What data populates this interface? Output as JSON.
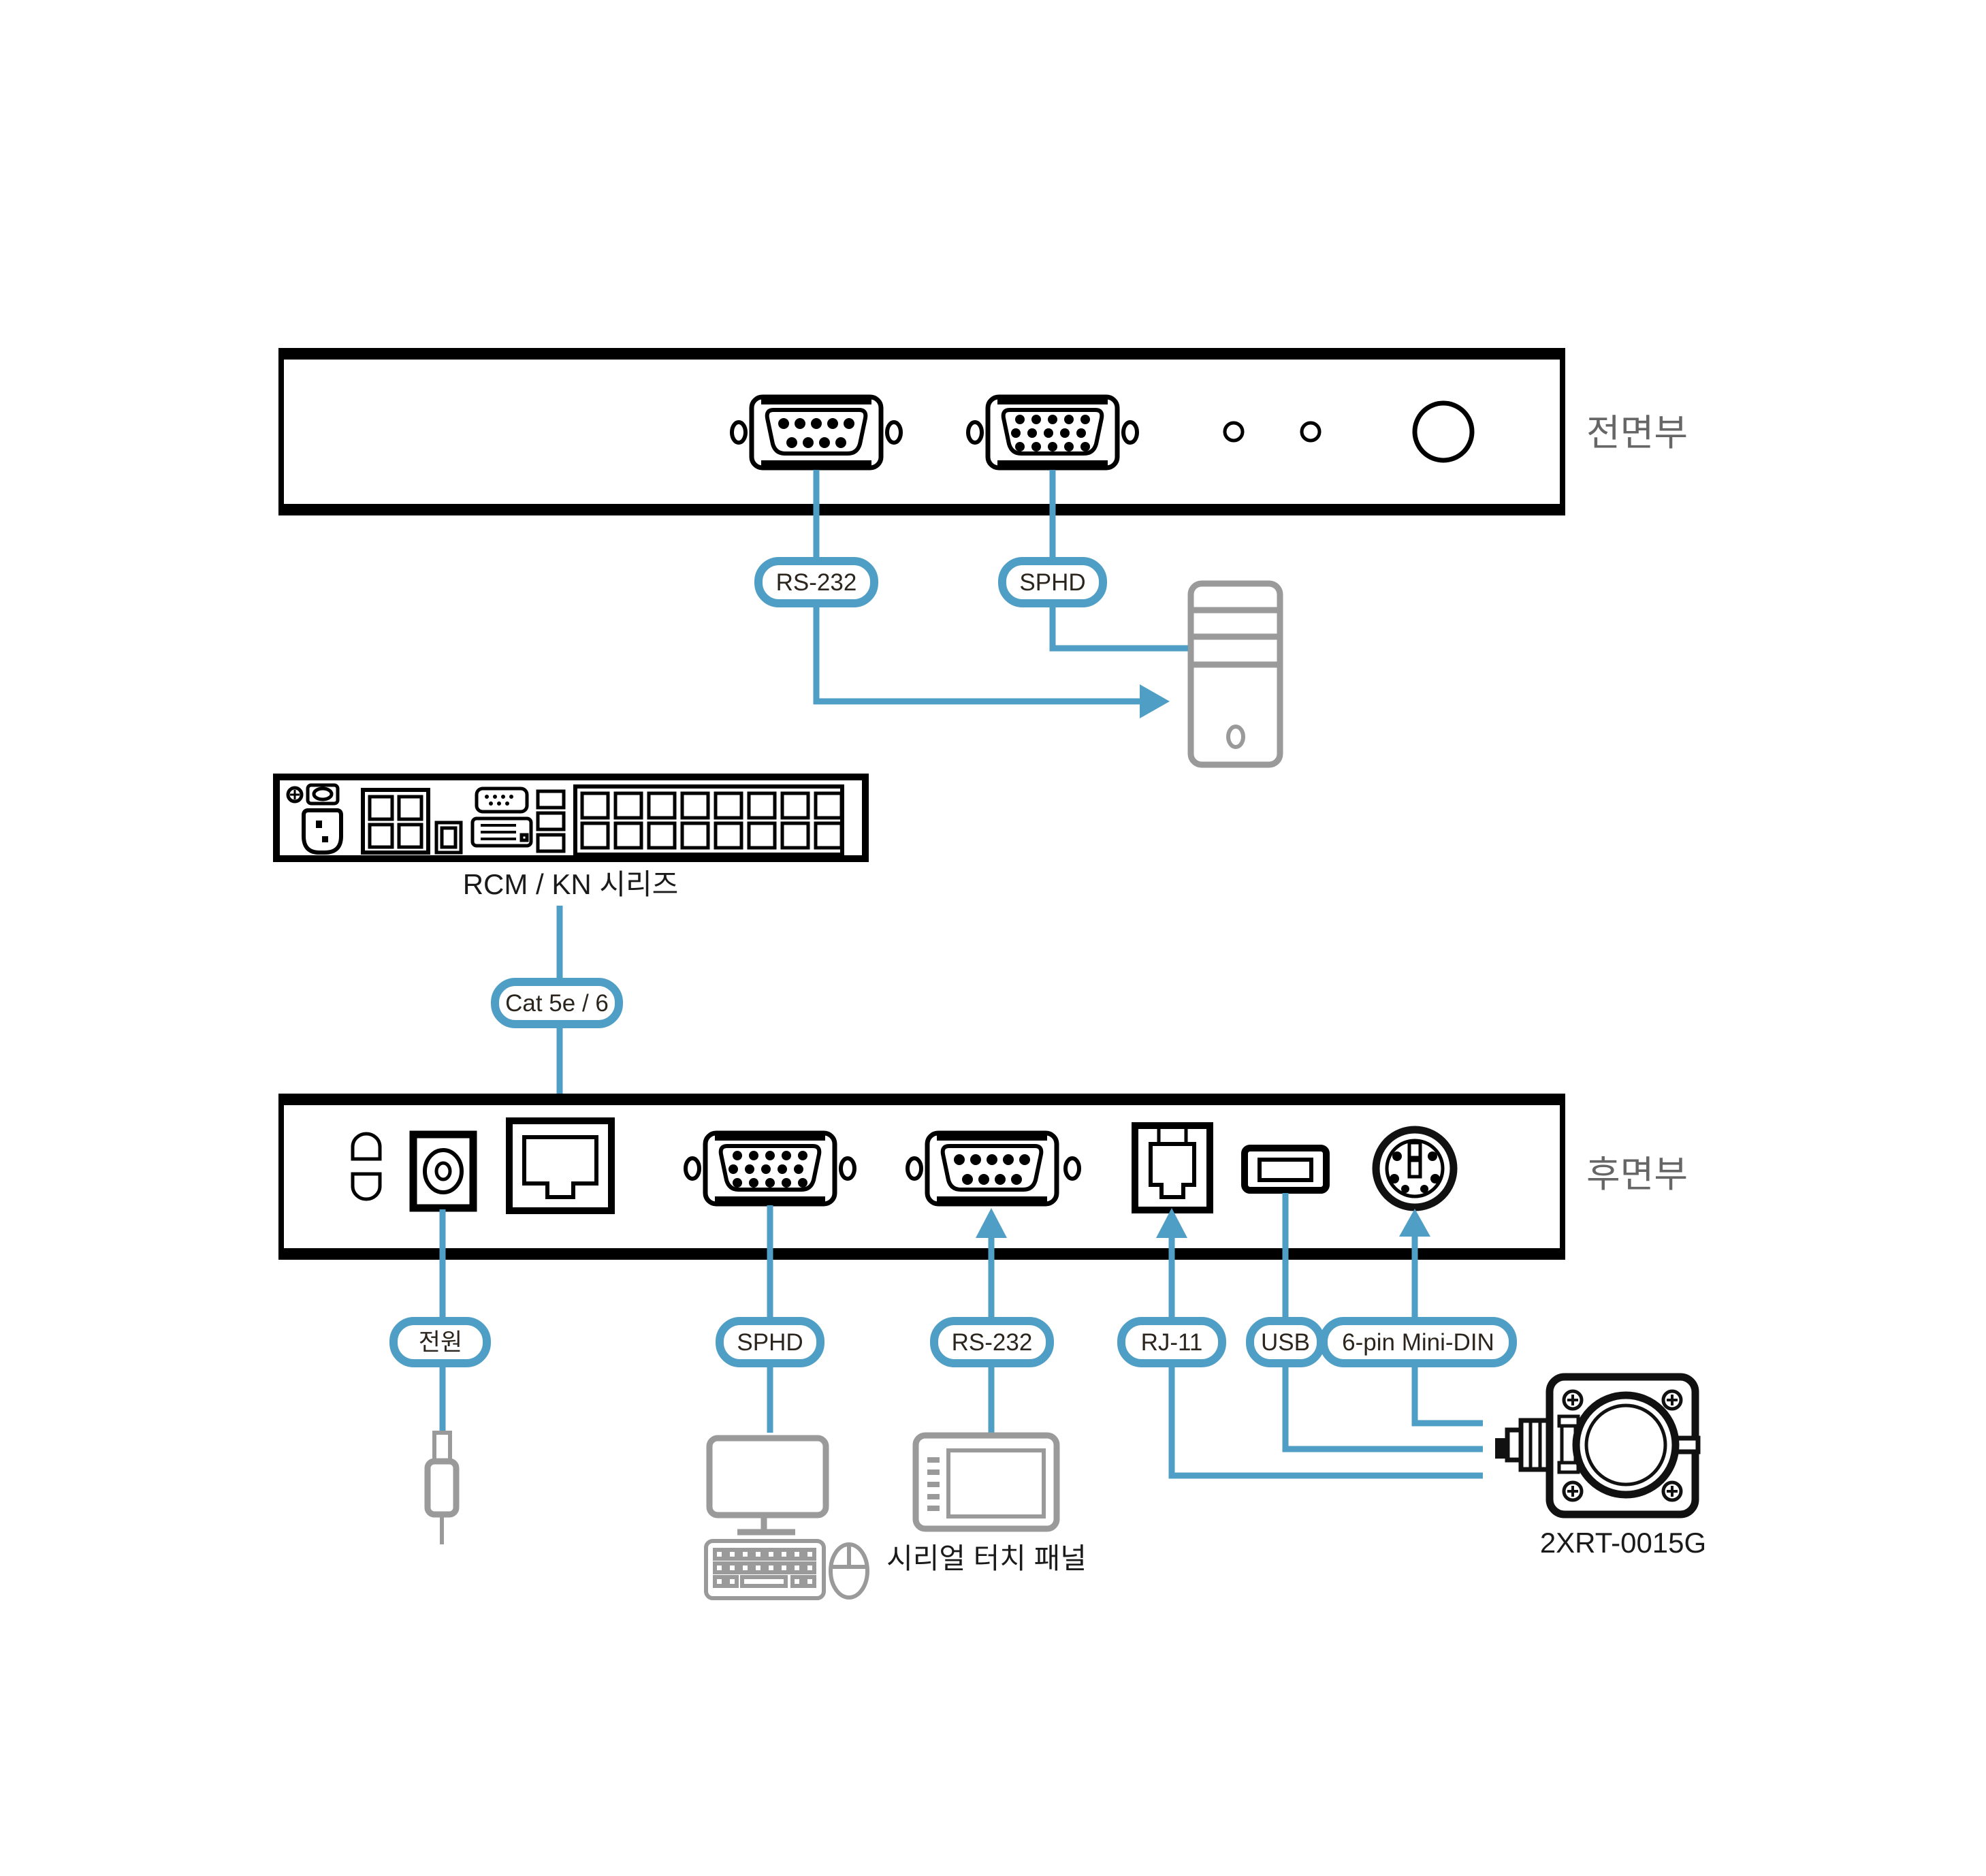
{
  "colors": {
    "accent_blue": "#4f9ec6",
    "device_gray": "#9a9a9a",
    "panel_label_gray": "#666666",
    "pill_text": "#2b251e",
    "ink": "#111111"
  },
  "front_panel": {
    "title": "전면부",
    "pills": {
      "rs232": "RS-232",
      "sphd": "SPHD"
    }
  },
  "matrix_unit": {
    "caption": "RCM / KN 시리즈",
    "cable_pill": "Cat 5e / 6"
  },
  "rear_panel": {
    "title": "후면부",
    "pills": {
      "power": "전원",
      "sphd": "SPHD",
      "rs232": "RS-232",
      "rj11": "RJ-11",
      "usb": "USB",
      "minidin": "6-pin Mini-DIN"
    }
  },
  "peripherals": {
    "touch_panel_caption": "시리얼 터치 패널",
    "camera_caption": "2XRT-0015G"
  }
}
